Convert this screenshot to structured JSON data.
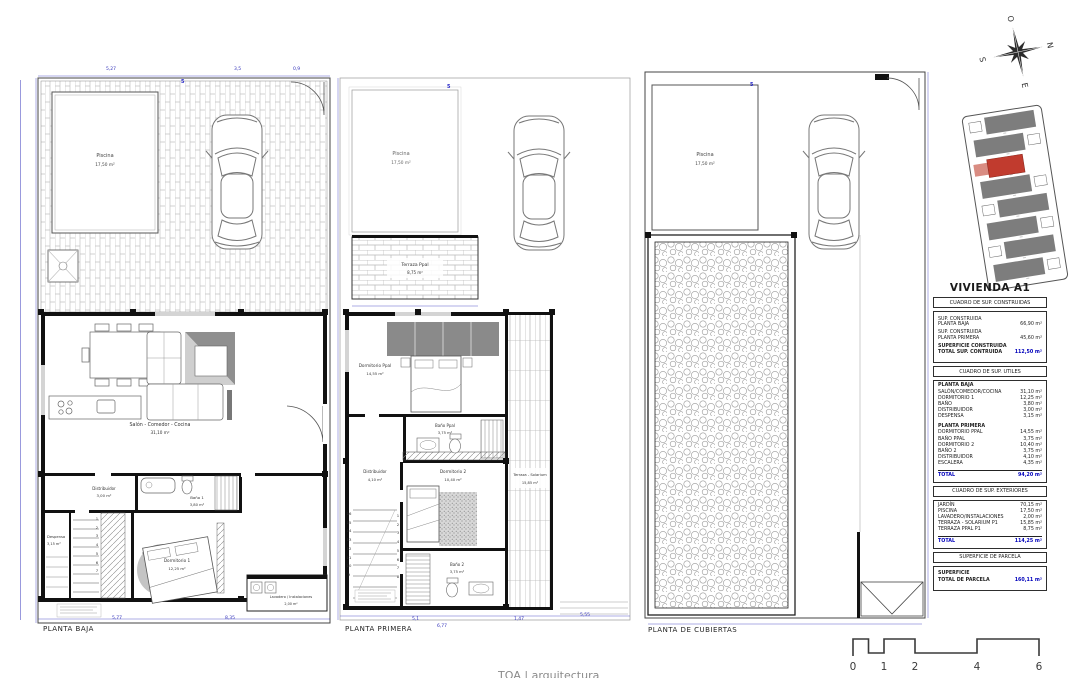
{
  "colors": {
    "dim_blue": "#3434bb",
    "accent_blue": "#0000bb",
    "wall": "#111111",
    "unit_red": "#c13b2e",
    "furniture_gray": "#8a8a8a"
  },
  "compass": {
    "n": "N",
    "e": "E",
    "s": "S",
    "o": "O"
  },
  "plans": [
    {
      "title": "PLANTA BAJA",
      "pool": {
        "name": "Piscina",
        "area": "17,50 m²"
      },
      "salon": {
        "name": "Salón - Comedor - Cocina",
        "area": "31,10 m²"
      },
      "distribuidor": {
        "name": "Distribuidor",
        "area": "3,00 m²"
      },
      "bano1": {
        "name": "Baño 1",
        "area": "3,80 m²"
      },
      "despensa": {
        "name": "Despensa",
        "area": "3,15 m²"
      },
      "dorm1": {
        "name": "Dormitorio 1",
        "area": "12,25 m²"
      },
      "lavadero": {
        "name": "Lavadero / Instalaciones",
        "area": "2,00 m²"
      },
      "dims_top": [
        "5,27",
        "3,5",
        "0,9"
      ],
      "dims_bottom": [
        "5,77",
        "8,35"
      ],
      "stair_numbers": [
        "1",
        "2",
        "3",
        "4",
        "5",
        "6",
        "7"
      ],
      "wall_code": "5"
    },
    {
      "title": "PLANTA PRIMERA",
      "pool": {
        "name": "Piscina",
        "area": "17,50 m²"
      },
      "terraza_ppal": {
        "name": "Terraza Ppal",
        "area": "8,75 m²"
      },
      "dorm_ppal": {
        "name": "Dormitorio Ppal",
        "area": "14,55 m²"
      },
      "bano_ppal": {
        "name": "Baño Ppal",
        "area": "3,75 m²"
      },
      "distribuidor": {
        "name": "Distribuidor",
        "area": "4,10 m²"
      },
      "dorm2": {
        "name": "Dormitorio 2",
        "area": "10,40 m²"
      },
      "bano2": {
        "name": "Baño 2",
        "area": "3,75 m²"
      },
      "solarium": {
        "name": "Terraza - Solarium",
        "area": "15,85 m²"
      },
      "dims_bottom": [
        "5,1",
        "6,77",
        "1,47",
        "5,55"
      ],
      "stair_left": [
        "16",
        "15",
        "14",
        "13",
        "12",
        "11",
        "10",
        "9"
      ],
      "stair_right": [
        "1",
        "2",
        "3",
        "4",
        "5",
        "6",
        "7",
        "8"
      ],
      "wall_code": "5"
    },
    {
      "title": "PLANTA DE CUBIERTAS",
      "pool": {
        "name": "Piscina",
        "area": "17,50 m²"
      },
      "wall_code": "5"
    }
  ],
  "panel": {
    "title": "VIVIENDA A1",
    "construidas": {
      "header": "CUADRO DE SUP. CONSTRUIDAS",
      "rows": [
        {
          "l1": "SUP. CONSTRUIDA",
          "l2": "PLANTA BAJA",
          "v": "66,90 m²"
        },
        {
          "l1": "SUP. CONSTRUIDA",
          "l2": "PLANTA PRIMERA",
          "v": "45,60 m²"
        }
      ],
      "total": {
        "l1": "SUPERFICIE CONSTRUIDA",
        "l2": "TOTAL SUP. CONTRUIDA",
        "v": "112,50 m²"
      }
    },
    "utiles": {
      "header": "CUADRO DE SUP. UTILES",
      "pb_title": "PLANTA BAJA",
      "pb": [
        {
          "l": "SALÓN/COMEDOR/COCINA",
          "v": "31,10 m²"
        },
        {
          "l": "DORMITORIO 1",
          "v": "12,25 m²"
        },
        {
          "l": "BAÑO",
          "v": "3,80 m²"
        },
        {
          "l": "DISTRIBUIDOR",
          "v": "3,00 m²"
        },
        {
          "l": "DESPENSA",
          "v": "3,15 m²"
        }
      ],
      "pp_title": "PLANTA PRIMERA",
      "pp": [
        {
          "l": "DORMITORIO PPAL",
          "v": "14,55 m²"
        },
        {
          "l": "BAÑO PPAL",
          "v": "3,75 m²"
        },
        {
          "l": "DORMITORIO 2",
          "v": "10,40 m²"
        },
        {
          "l": "BAÑO 2",
          "v": "3,75 m²"
        },
        {
          "l": "DISTRIBUIDOR",
          "v": "4,10 m²"
        },
        {
          "l": "ESCALERA",
          "v": "4,35 m²"
        }
      ],
      "total_label": "TOTAL",
      "total_value": "94,20 m²"
    },
    "exteriores": {
      "header": "CUADRO DE SUP. EXTERIORES",
      "rows": [
        {
          "l": "JARDÍN",
          "v": "70,15 m²"
        },
        {
          "l": "PISCINA",
          "v": "17,50 m²"
        },
        {
          "l": "LAVADERO/INSTALACIONES",
          "v": "2,00 m²"
        },
        {
          "l": "TERRAZA - SOLARIUM P1",
          "v": "15,85 m²"
        },
        {
          "l": "TERRAZA PPAL P1",
          "v": "8,75 m²"
        }
      ],
      "total_label": "TOTAL",
      "total_value": "114,25 m²"
    },
    "parcela": {
      "header": "SUPERFICIE DE PARCELA",
      "l1": "SUPERFICIE",
      "l2": "TOTAL DE PARCELA",
      "v": "160,11 m²"
    }
  },
  "scalebar": {
    "labels": [
      "0",
      "1",
      "2",
      "4",
      "6"
    ]
  },
  "footer": "TQA | arquitectura"
}
